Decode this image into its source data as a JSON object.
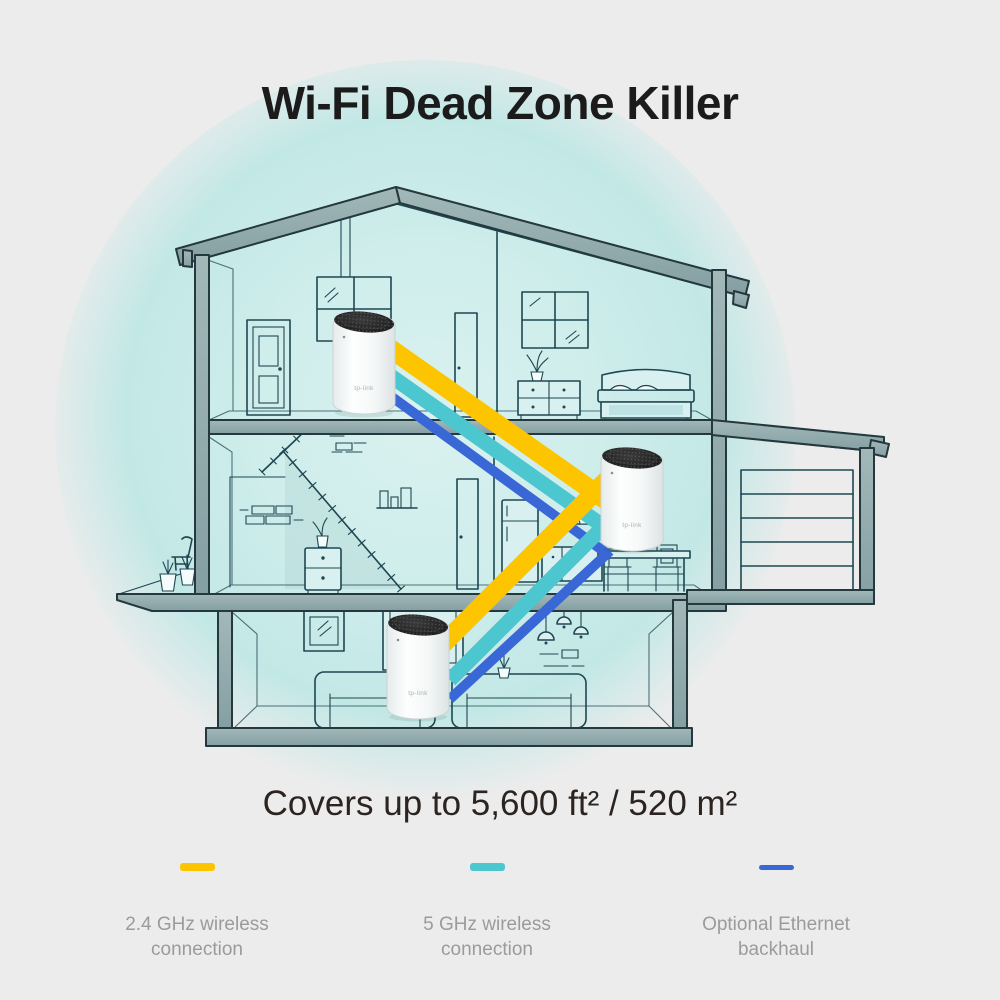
{
  "title": "Wi-Fi Dead Zone Killer",
  "coverage": "Covers up to 5,600 ft² / 520 m²",
  "legend": {
    "items": [
      {
        "label": "2.4 GHz wireless connection",
        "color": "#FCC500",
        "swatch": "thick"
      },
      {
        "label": "5 GHz wireless connection",
        "color": "#4CC6CF",
        "swatch": "thick"
      },
      {
        "label": "Optional Ethernet backhaul",
        "color": "#3A67D6",
        "swatch": "thin"
      }
    ]
  },
  "illustration": {
    "device_brand": "tp-link",
    "colors": {
      "band_24ghz": "#FCC500",
      "band_5ghz": "#4CC6CF",
      "band_ethernet": "#3A67D6",
      "beam": "#8FA7A9",
      "line": "#1E4752",
      "room": "#C9EAE9",
      "glow": "#C2E8E6",
      "background": "#ECECEC"
    }
  }
}
